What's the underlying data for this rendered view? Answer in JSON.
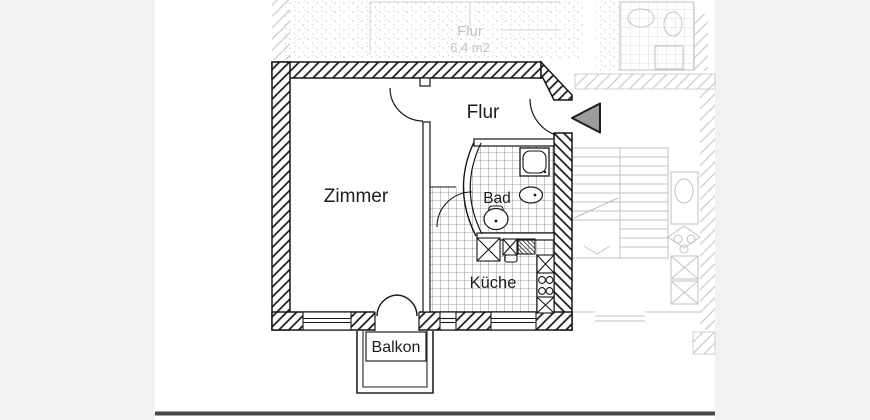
{
  "document": {
    "kind": "apartment floor plan scan",
    "background": {
      "margin": "#f2f2f2",
      "paper": "#ffffff",
      "scan_edge": "#474747"
    },
    "palette": {
      "ink": "#1b1b1b",
      "ghost": "#c2c2c2",
      "arrow_fill": "#9c9c9c"
    }
  },
  "rooms": {
    "zimmer": "Zimmer",
    "flur": "Flur",
    "bad": "Bad",
    "kueche": "Küche",
    "balkon": "Balkon"
  },
  "ghost": {
    "label_room": "Flur",
    "label_area": "6,4 m2"
  },
  "symbols": [
    "entrance-arrow",
    "door-swing",
    "window",
    "shower",
    "washbasin",
    "toilet",
    "stove",
    "kitchen-sink",
    "cabinet",
    "stairs",
    "balcony"
  ]
}
